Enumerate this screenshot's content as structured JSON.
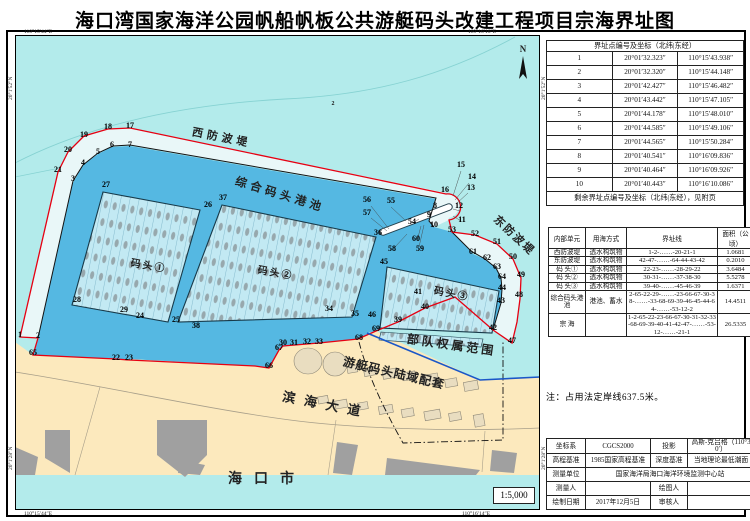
{
  "title": "海口湾国家海洋公园帆船帆板公共游艇码头改建工程项目宗海界址图",
  "map": {
    "scale_label": "1:5,000",
    "corner_coords": {
      "top_left": "110°15′44″E",
      "top_right": "110°16′16″E",
      "bottom_left": "110°15′44″E",
      "bottom_right": "110°16′14″E",
      "lat_left_top": "20°1′52″N",
      "lat_left_bottom": "20°1′28″N",
      "lat_right_top": "20°1′52″N",
      "lat_right_bottom": "20°1′28″N"
    },
    "area_labels": [
      {
        "text": "西防波堤",
        "x": 206,
        "y": 106,
        "rot": 11,
        "fs": 11,
        "ls": 4
      },
      {
        "text": "综合码头港池",
        "x": 264,
        "y": 163,
        "rot": 17,
        "fs": 11.5,
        "ls": 4
      },
      {
        "text": "东防波堤",
        "x": 497,
        "y": 203,
        "rot": 43,
        "fs": 11,
        "ls": 2
      },
      {
        "text": "码头①",
        "x": 133,
        "y": 234,
        "rot": 10,
        "fs": 10,
        "ls": 2
      },
      {
        "text": "码头②",
        "x": 260,
        "y": 241,
        "rot": 10,
        "fs": 10,
        "ls": 2
      },
      {
        "text": "码头③",
        "x": 436,
        "y": 262,
        "rot": 11,
        "fs": 10,
        "ls": 2
      },
      {
        "text": "部队权属范围",
        "x": 436,
        "y": 314,
        "rot": 8,
        "fs": 12,
        "ls": 3
      },
      {
        "text": "游艇码头陆域配套",
        "x": 378,
        "y": 342,
        "rot": 13,
        "fs": 12,
        "ls": 1
      },
      {
        "text": "滨海大道",
        "x": 310,
        "y": 374,
        "rot": 11,
        "fs": 13,
        "ls": 9
      },
      {
        "text": "海口市",
        "x": 252,
        "y": 448,
        "rot": 0,
        "fs": 14,
        "ls": 12
      },
      {
        "text": "N",
        "x": 508,
        "y": 17,
        "rot": 0,
        "fs": 9,
        "ls": 0
      },
      {
        "text": "2",
        "x": 318,
        "y": 70,
        "rot": 0,
        "fs": 6,
        "ls": 0
      }
    ],
    "boundary_points": [
      [
        1,
        5,
        302
      ],
      [
        2,
        23,
        303
      ],
      [
        3,
        58,
        146
      ],
      [
        4,
        68,
        130
      ],
      [
        5,
        83,
        119
      ],
      [
        6,
        97,
        112
      ],
      [
        7,
        115,
        112
      ],
      [
        8,
        420,
        173
      ],
      [
        9,
        414,
        182
      ],
      [
        10,
        419,
        192
      ],
      [
        11,
        447,
        187
      ],
      [
        12,
        444,
        173
      ],
      [
        13,
        456,
        155
      ],
      [
        14,
        457,
        144
      ],
      [
        15,
        446,
        132
      ],
      [
        16,
        430,
        157
      ],
      [
        17,
        115,
        93
      ],
      [
        18,
        93,
        94
      ],
      [
        19,
        69,
        102
      ],
      [
        20,
        53,
        117
      ],
      [
        21,
        43,
        137
      ],
      [
        22,
        101,
        325
      ],
      [
        23,
        114,
        325
      ],
      [
        24,
        125,
        283
      ],
      [
        25,
        161,
        287
      ],
      [
        26,
        193,
        172
      ],
      [
        27,
        91,
        152
      ],
      [
        28,
        62,
        267
      ],
      [
        29,
        109,
        277
      ],
      [
        30,
        268,
        310
      ],
      [
        31,
        279,
        310
      ],
      [
        32,
        292,
        309
      ],
      [
        33,
        304,
        309
      ],
      [
        34,
        314,
        276
      ],
      [
        35,
        340,
        281
      ],
      [
        36,
        363,
        200
      ],
      [
        37,
        208,
        165
      ],
      [
        38,
        181,
        293
      ],
      [
        39,
        383,
        287
      ],
      [
        40,
        410,
        274
      ],
      [
        41,
        403,
        259
      ],
      [
        42,
        478,
        295
      ],
      [
        43,
        486,
        268
      ],
      [
        44,
        487,
        255
      ],
      [
        45,
        369,
        229
      ],
      [
        46,
        357,
        282
      ],
      [
        47,
        497,
        308
      ],
      [
        48,
        504,
        262
      ],
      [
        49,
        506,
        242
      ],
      [
        50,
        498,
        224
      ],
      [
        51,
        482,
        209
      ],
      [
        52,
        460,
        201
      ],
      [
        53,
        437,
        197
      ],
      [
        54,
        397,
        189
      ],
      [
        55,
        376,
        168
      ],
      [
        56,
        352,
        167
      ],
      [
        57,
        352,
        180
      ],
      [
        58,
        377,
        216
      ],
      [
        59,
        405,
        216
      ],
      [
        60,
        401,
        206
      ],
      [
        61,
        458,
        219
      ],
      [
        62,
        472,
        225
      ],
      [
        63,
        482,
        234
      ],
      [
        64,
        487,
        244
      ],
      [
        65,
        18,
        320
      ],
      [
        66,
        254,
        333
      ],
      [
        67,
        264,
        315
      ],
      [
        68,
        344,
        305
      ],
      [
        69,
        361,
        296
      ]
    ]
  },
  "tables": {
    "boundary_coords": {
      "header": "界址点编号及坐标（北纬|东经）",
      "rows": [
        [
          "1",
          "20°01′32.323″",
          "110°15′43.938″"
        ],
        [
          "2",
          "20°01′32.320″",
          "110°15′44.148″"
        ],
        [
          "3",
          "20°01′42.427″",
          "110°15′46.482″"
        ],
        [
          "4",
          "20°01′43.442″",
          "110°15′47.105″"
        ],
        [
          "5",
          "20°01′44.178″",
          "110°15′48.010″"
        ],
        [
          "6",
          "20°01′44.585″",
          "110°15′49.106″"
        ],
        [
          "7",
          "20°01′44.565″",
          "110°15′50.284″"
        ],
        [
          "8",
          "20°01′40.541″",
          "110°16′09.836″"
        ],
        [
          "9",
          "20°01′40.464″",
          "110°16′09.926″"
        ],
        [
          "10",
          "20°01′40.443″",
          "110°16′10.086″"
        ]
      ],
      "footer": "剩余界址点编号及坐标（北纬|东经），见附页"
    },
    "units": {
      "headers": [
        "内部单元",
        "用海方式",
        "界址线",
        "面积（公顷）"
      ],
      "rows": [
        [
          "西防波堤",
          "透水构筑物",
          "1-2-……-20-21-1",
          "1.0681"
        ],
        [
          "东防波堤",
          "透水构筑物",
          "42-47-……-64-44-43-42",
          "0.2010"
        ],
        [
          "码 头①",
          "透水构筑物",
          "22-23-……-28-29-22",
          "3.6484"
        ],
        [
          "码 头②",
          "透水构筑物",
          "30-31-……-37-38-30",
          "5.5278"
        ],
        [
          "码 头③",
          "透水构筑物",
          "39-40-……-45-46-39",
          "1.6371"
        ],
        [
          "综合码头港池",
          "港池、蓄水",
          "2-65-22-29-……-23-66-67-30-38-……-33-68-69-39-46-45-44-64-……-53-12-2",
          "14.4511"
        ],
        [
          "宗 海",
          "",
          "1-2-65-22-23-66-67-30-31-32-33-68-69-39-40-41-42-47-……-53-12-……-21-1",
          "26.5335"
        ]
      ]
    },
    "survey_info": {
      "rows": [
        [
          {
            "t": "坐标系"
          },
          {
            "t": "CGCS2000"
          },
          {
            "t": "投影"
          },
          {
            "t": "高斯-克吕格（110°30′）"
          }
        ],
        [
          {
            "t": "高程基准"
          },
          {
            "t": "1985国家高程基准"
          },
          {
            "t": "深度基准"
          },
          {
            "t": "当地理论最低潮面"
          }
        ],
        [
          {
            "t": "测量单位"
          },
          {
            "t": "国家海洋局海口海洋环境监测中心站",
            "cs": 3
          }
        ],
        [
          {
            "t": "测量人"
          },
          {
            "t": ""
          },
          {
            "t": "绘图人"
          },
          {
            "t": ""
          }
        ],
        [
          {
            "t": "绘制日期"
          },
          {
            "t": "2017年12月5日"
          },
          {
            "t": "审核人"
          },
          {
            "t": ""
          }
        ]
      ]
    }
  },
  "note": "注：占用法定岸线637.5米。",
  "colors": {
    "sea": "#b3ebeb",
    "basin": "#55b8e2",
    "land": "#fce9bd",
    "building": "#a0a0a0",
    "boundary_red": "#e60012",
    "military_line_blue": "#1b57c8",
    "dock_fill": "#c2e9f3"
  }
}
